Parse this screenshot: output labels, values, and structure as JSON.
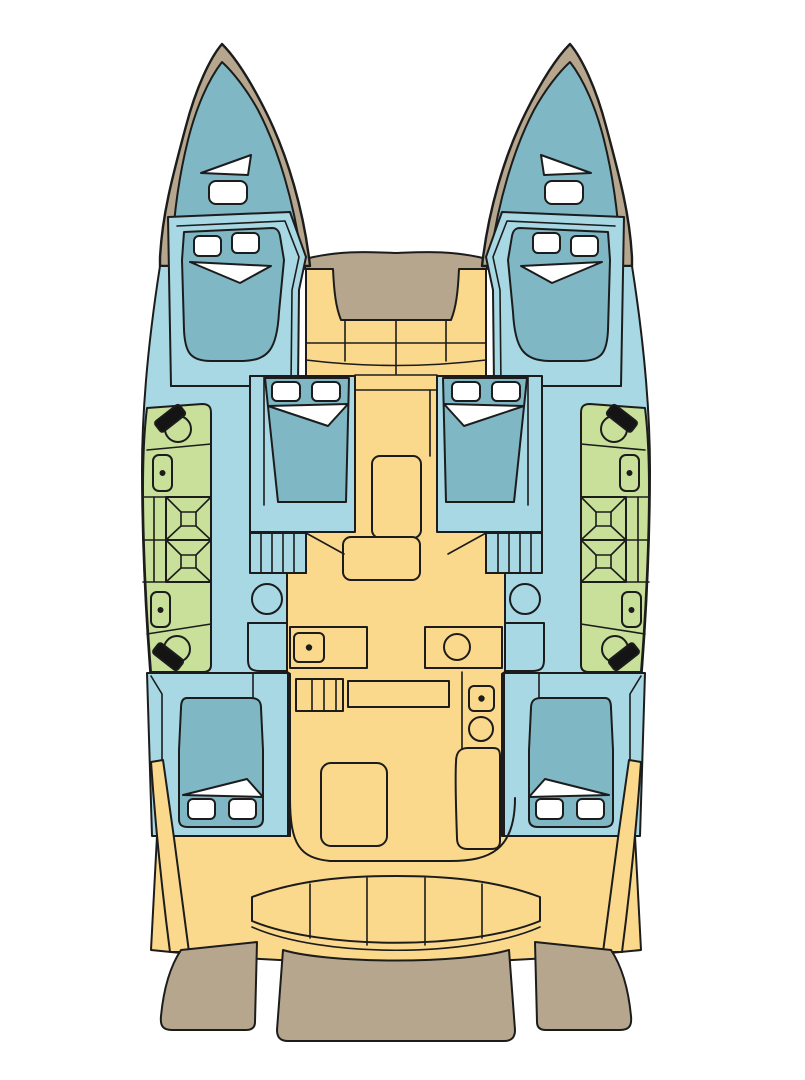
{
  "document": {
    "kind": "yacht deck plan",
    "vessel": "sailing catamaran",
    "view": "top-down interior layout",
    "canvas": {
      "width": 805,
      "height": 1080
    }
  },
  "colors": {
    "background": "#ffffff",
    "outline": "#1c1c1c",
    "exterior_deck": "#b5a68d",
    "interior_floor": "#fbd98c",
    "cabin_floor": "#a7d8e4",
    "berth": "#7fb7c5",
    "bathroom": "#c9e09a",
    "linen": "#ffffff",
    "toilet_lid": "#141414"
  },
  "layout": {
    "hulls": [
      "port",
      "starboard"
    ],
    "symmetry": "mirrored about vessel centerline",
    "counts": {
      "forepeak_berths": 2,
      "double_cabins": 6,
      "bathrooms_per_hull": 2,
      "shower_stalls_per_hull": 2,
      "toilets_per_hull": 2,
      "washbasins_per_hull": 2,
      "hull_stairways": 2,
      "cockpit_bench_segments": 5,
      "foredeck_seat_segments": 4,
      "swim_platforms": 3
    }
  },
  "rooms": [
    {
      "name": "port forepeak berth",
      "zone": "bow",
      "fill": "berth"
    },
    {
      "name": "starboard forepeak berth",
      "zone": "bow",
      "fill": "berth"
    },
    {
      "name": "port forward cabin",
      "berth": "double",
      "pillows": 2,
      "fill": "cabin_floor"
    },
    {
      "name": "starboard forward cabin",
      "berth": "double",
      "pillows": 2,
      "fill": "cabin_floor"
    },
    {
      "name": "port mid cabin",
      "berth": "double",
      "pillows": 2,
      "fill": "cabin_floor"
    },
    {
      "name": "starboard mid cabin",
      "berth": "double",
      "pillows": 2,
      "fill": "cabin_floor"
    },
    {
      "name": "port aft cabin",
      "berth": "double",
      "pillows": 2,
      "fill": "cabin_floor"
    },
    {
      "name": "starboard aft cabin",
      "berth": "double",
      "pillows": 2,
      "fill": "cabin_floor"
    },
    {
      "name": "port bathroom suite",
      "fixtures": [
        "toilet",
        "washbasin",
        "shower stall",
        "shower stall",
        "washbasin",
        "toilet"
      ],
      "fill": "bathroom"
    },
    {
      "name": "starboard bathroom suite",
      "fixtures": [
        "toilet",
        "washbasin",
        "shower stall",
        "shower stall",
        "washbasin",
        "toilet"
      ],
      "fill": "bathroom"
    },
    {
      "name": "salon and galley",
      "fixtures": [
        "counter with sink",
        "counter with round basin",
        "island counter",
        "salon table",
        "chart seat",
        "appliance column",
        "companionway steps"
      ],
      "fill": "interior_floor"
    },
    {
      "name": "cockpit",
      "fixtures": [
        "curved bench seat",
        "cockpit table"
      ],
      "fill": "interior_floor"
    },
    {
      "name": "foredeck",
      "fixtures": [
        "deck pad",
        "forward bench seating"
      ],
      "fill": "exterior_deck"
    },
    {
      "name": "aft swim platform",
      "fill": "exterior_deck"
    }
  ]
}
